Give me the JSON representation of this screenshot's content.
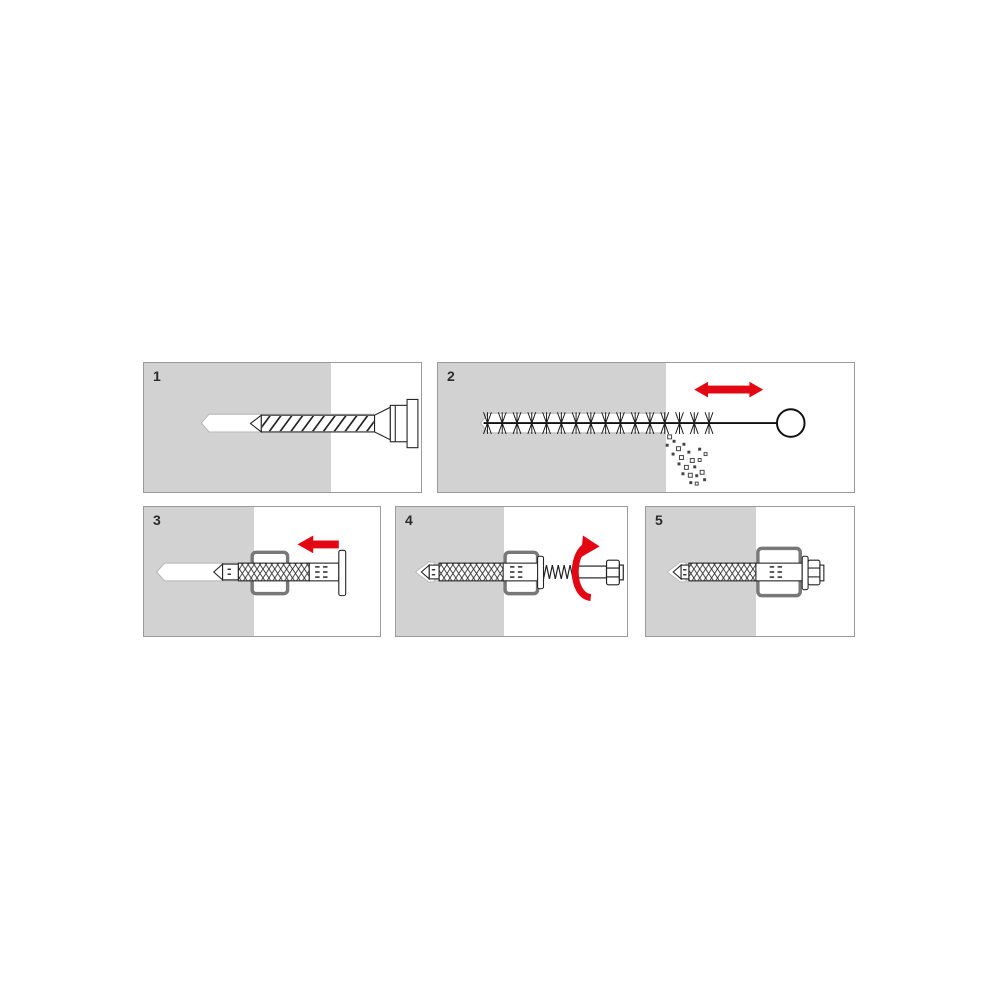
{
  "colors": {
    "accent-red": "#e30613",
    "wall-gray": "#d2d2d2",
    "panel-border": "#9a9a9a",
    "outline": "#1f1f1f",
    "hole-outline": "#b5b5b5",
    "fixture-gray": "#787878"
  },
  "panels": [
    {
      "number": "1",
      "icon": "drill-bit-icon"
    },
    {
      "number": "2",
      "icon": "cleaning-brush-icon"
    },
    {
      "number": "3",
      "icon": "insert-anchor-icon"
    },
    {
      "number": "4",
      "icon": "screwdriving-icon"
    },
    {
      "number": "5",
      "icon": "installed-anchor-icon"
    }
  ]
}
